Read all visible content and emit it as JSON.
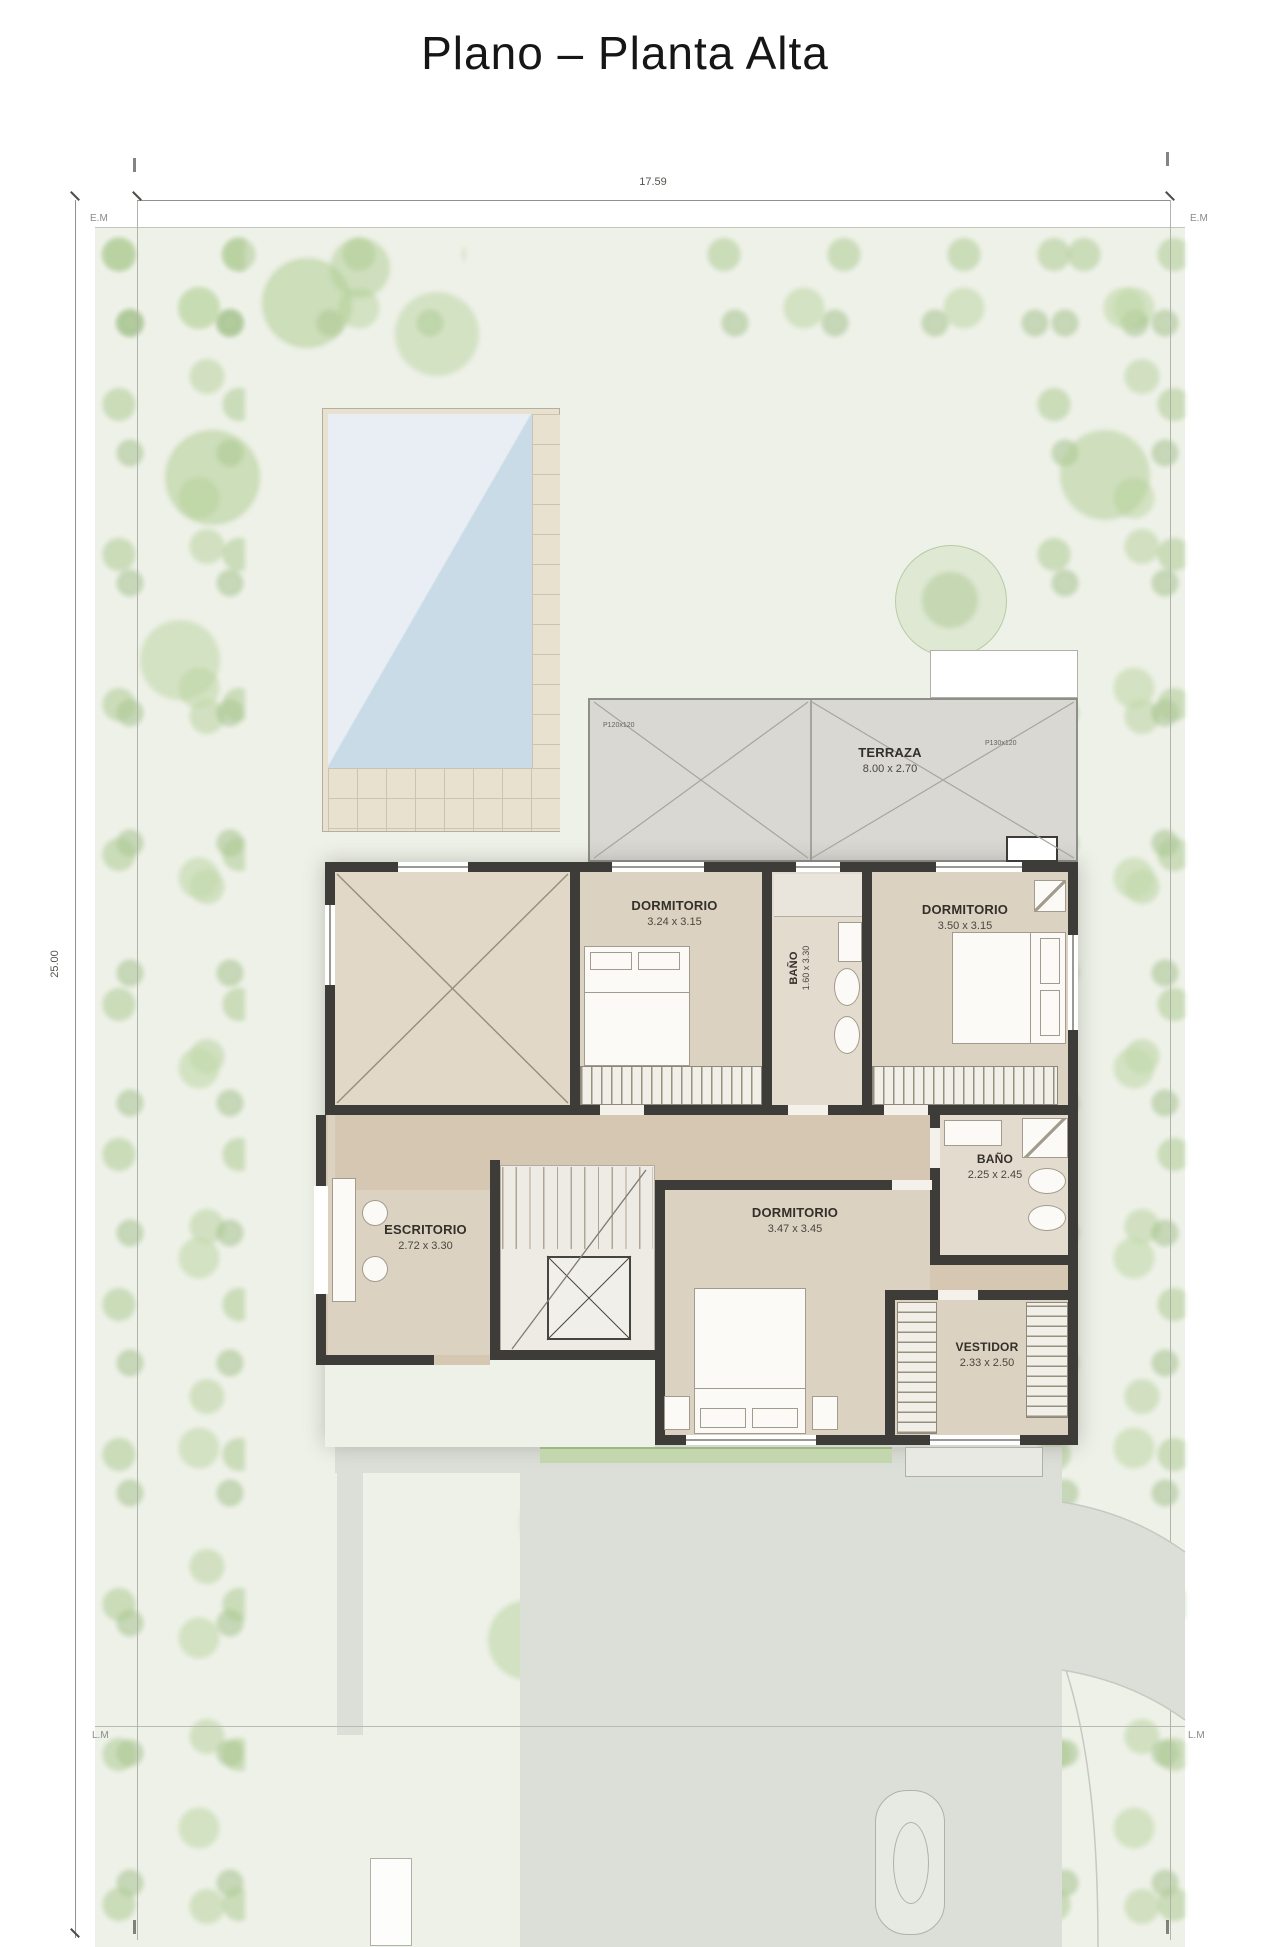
{
  "title": "Plano – Planta Alta",
  "site": {
    "width_label": "17.59",
    "depth_label": "25.00",
    "boundary_top_left": "E.M",
    "boundary_top_right": "E.M",
    "boundary_bottom_left": "L.M",
    "boundary_bottom_right": "L.M"
  },
  "rooms": {
    "terraza": {
      "name": "TERRAZA",
      "size": "8.00 x 2.70",
      "tag_left": "P120x120",
      "tag_right": "P130x120"
    },
    "dormitorio_1": {
      "name": "DORMITORIO",
      "size": "3.24 x 3.15"
    },
    "banio_1": {
      "name": "BAÑO",
      "size": "1.60 x 3.30"
    },
    "dormitorio_2": {
      "name": "DORMITORIO",
      "size": "3.50 x 3.15"
    },
    "escritorio": {
      "name": "ESCRITORIO",
      "size": "2.72 x 3.30"
    },
    "dormitorio_3": {
      "name": "DORMITORIO",
      "size": "3.47 x 3.45"
    },
    "banio_2": {
      "name": "BAÑO",
      "size": "2.25 x 2.45"
    },
    "vestidor": {
      "name": "VESTIDOR",
      "size": "2.33 x 2.50"
    }
  },
  "colors": {
    "wall": "#3d3c39",
    "room_floor": "#dcd2c2",
    "hall_floor": "#d5c7b2",
    "bath_floor": "#e3dbce",
    "terrace": "#d9d8d3",
    "pool_water": "#cfdfe9",
    "deck": "#e9e1d0",
    "lawn": "#eef1e8",
    "vegetation": "#b8d2a4",
    "paving": "#dcded8",
    "dimension_line": "#8e938c",
    "label_text": "#33302a"
  }
}
